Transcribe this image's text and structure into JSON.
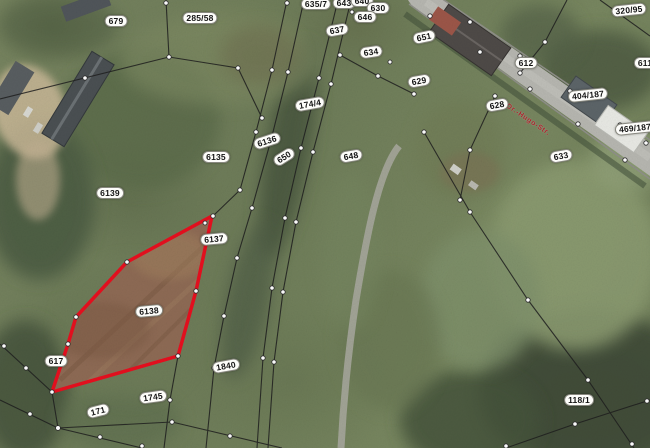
{
  "map": {
    "kind": "cadastral-parcel-map-over-aerial-photo",
    "street_name": "Dr.-Hugo-Str.",
    "highlighted_parcels": [
      "6137",
      "6138"
    ],
    "colors": {
      "highlight_outline": "#e60f1e",
      "highlight_field_fill": "#8d6a54",
      "boundary_line": "#222222",
      "survey_point_fill": "#ffffff",
      "badge_background": "#fdfdfa",
      "road_surface": "#b6b6b0",
      "street_name_text": "#a8232b"
    },
    "parcel_labels": [
      {
        "text": "679",
        "x": 116,
        "y": 21,
        "rot": 0
      },
      {
        "text": "285/58",
        "x": 200,
        "y": 18,
        "rot": 0
      },
      {
        "text": "635/7",
        "x": 316,
        "y": 4,
        "rot": 0
      },
      {
        "text": "643",
        "x": 344,
        "y": 3,
        "rot": 0
      },
      {
        "text": "640",
        "x": 362,
        "y": 1,
        "rot": 0
      },
      {
        "text": "637",
        "x": 337,
        "y": 30,
        "rot": -10
      },
      {
        "text": "630",
        "x": 378,
        "y": 8,
        "rot": 0
      },
      {
        "text": "646",
        "x": 365,
        "y": 17,
        "rot": 0
      },
      {
        "text": "651",
        "x": 424,
        "y": 37,
        "rot": -12
      },
      {
        "text": "634",
        "x": 371,
        "y": 52,
        "rot": -8
      },
      {
        "text": "629",
        "x": 419,
        "y": 81,
        "rot": -10
      },
      {
        "text": "612",
        "x": 526,
        "y": 63,
        "rot": 0
      },
      {
        "text": "611",
        "x": 645,
        "y": 63,
        "rot": 0
      },
      {
        "text": "320/95",
        "x": 629,
        "y": 10,
        "rot": -6
      },
      {
        "text": "404/187",
        "x": 588,
        "y": 95,
        "rot": -6
      },
      {
        "text": "469/187",
        "x": 635,
        "y": 128,
        "rot": -6
      },
      {
        "text": "628",
        "x": 497,
        "y": 105,
        "rot": -10
      },
      {
        "text": "633",
        "x": 561,
        "y": 156,
        "rot": -10
      },
      {
        "text": "174/4",
        "x": 310,
        "y": 104,
        "rot": -10
      },
      {
        "text": "6136",
        "x": 267,
        "y": 141,
        "rot": -18
      },
      {
        "text": "6135",
        "x": 216,
        "y": 157,
        "rot": 0
      },
      {
        "text": "650",
        "x": 284,
        "y": 157,
        "rot": -32
      },
      {
        "text": "648",
        "x": 351,
        "y": 156,
        "rot": -10
      },
      {
        "text": "6139",
        "x": 110,
        "y": 193,
        "rot": 0
      },
      {
        "text": "6137",
        "x": 214,
        "y": 239,
        "rot": -5
      },
      {
        "text": "6138",
        "x": 149,
        "y": 311,
        "rot": -5
      },
      {
        "text": "617",
        "x": 56,
        "y": 361,
        "rot": 0
      },
      {
        "text": "1840",
        "x": 226,
        "y": 366,
        "rot": -10
      },
      {
        "text": "1745",
        "x": 153,
        "y": 397,
        "rot": -8
      },
      {
        "text": "171",
        "x": 98,
        "y": 411,
        "rot": -14
      },
      {
        "text": "118/1",
        "x": 579,
        "y": 400,
        "rot": 0
      }
    ]
  }
}
